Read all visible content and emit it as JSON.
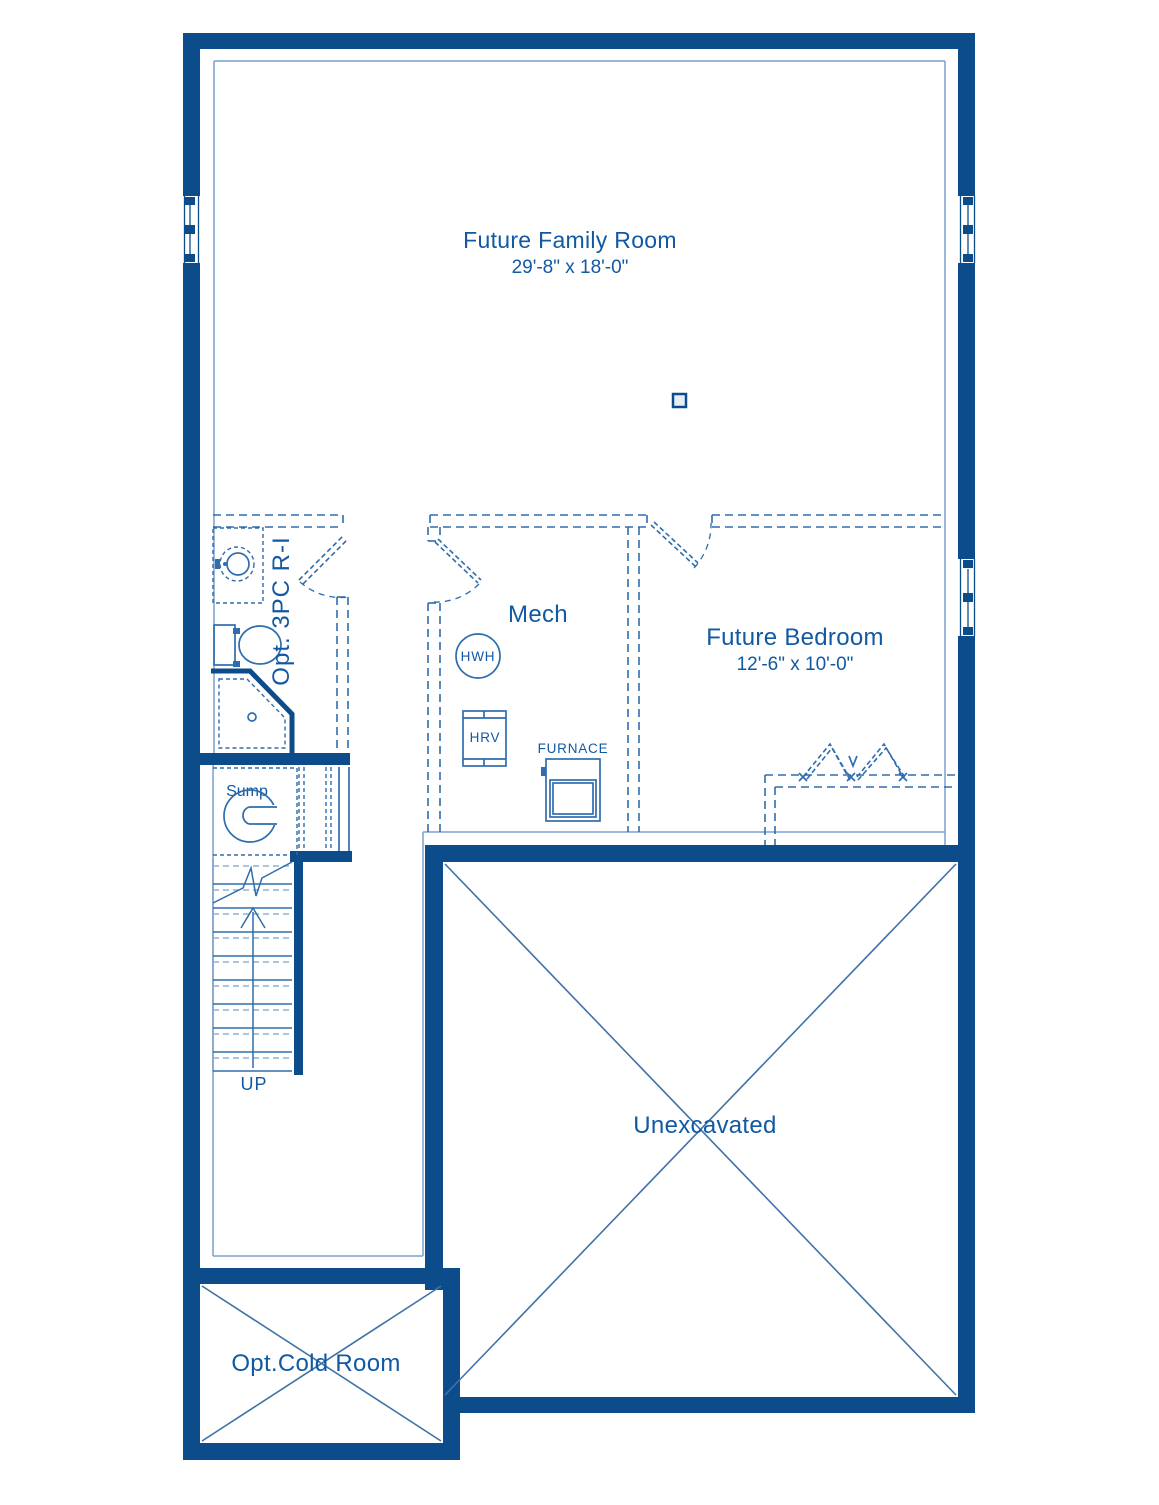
{
  "colors": {
    "wall": "#0d4c8a",
    "dashed_line": "#2f6dad",
    "thin_line": "#7d9fca",
    "label_text": "#1159a3"
  },
  "rooms": {
    "family_room": {
      "name": "Future Family Room",
      "dims": "29'-8\" x 18'-0\""
    },
    "bedroom": {
      "name": "Future Bedroom",
      "dims": "12'-6\" x 10'-0\""
    },
    "mech": {
      "name": "Mech"
    },
    "bath": {
      "name": "Opt. 3PC R-I"
    },
    "sump": {
      "name": "Sump"
    },
    "unexcavated": {
      "name": "Unexcavated"
    },
    "cold_room": {
      "name": "Opt.Cold Room"
    },
    "stairs": {
      "name": "UP"
    }
  },
  "equipment": {
    "hwh": "HWH",
    "hrv": "HRV",
    "furnace": "FURNACE"
  }
}
